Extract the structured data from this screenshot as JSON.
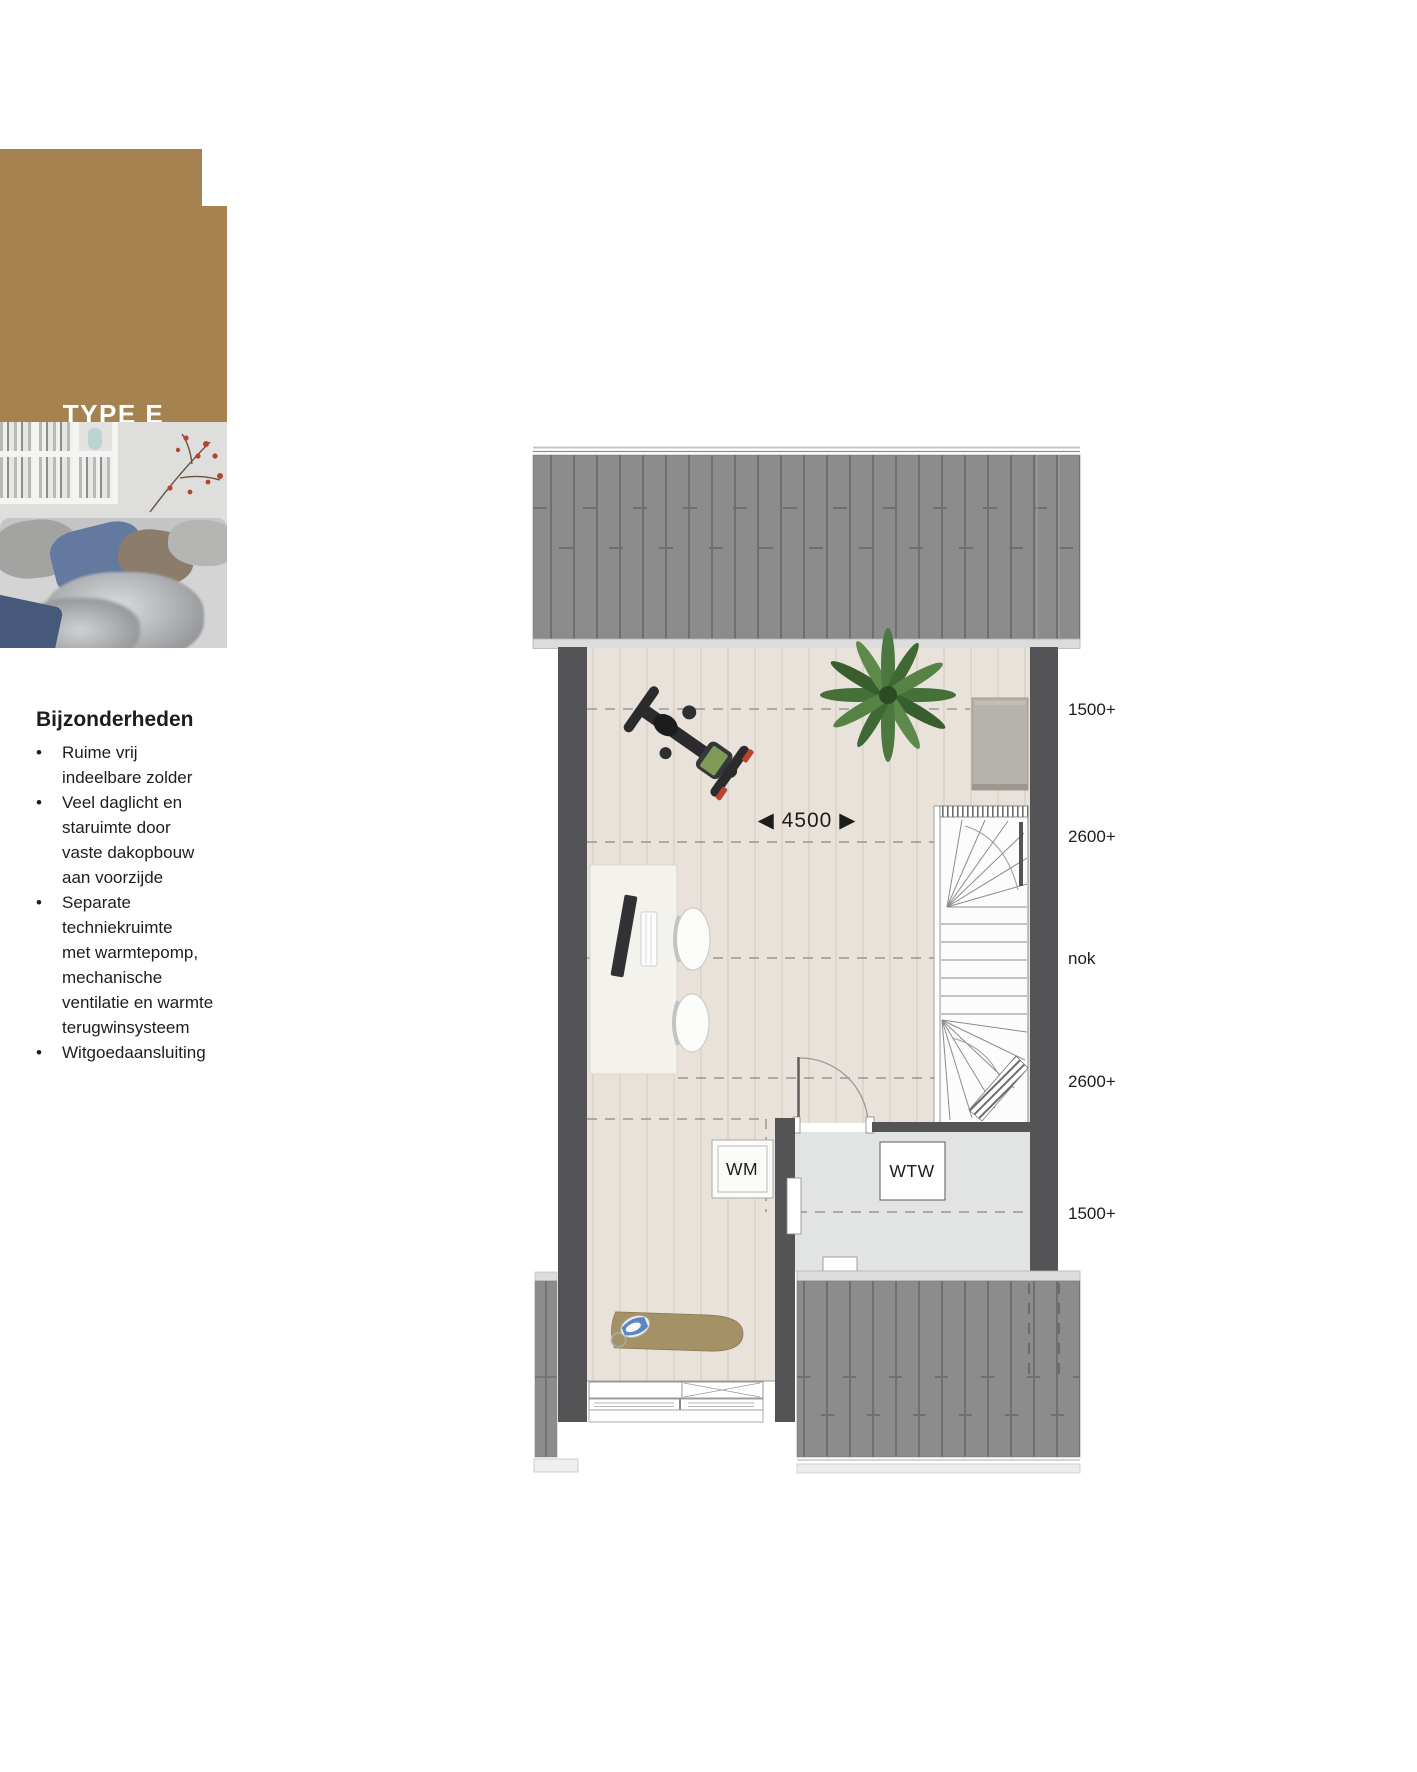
{
  "panel": {
    "type_label": "TYPE E",
    "floor_label": "zolder",
    "scale_label": "schaal 1:60",
    "accent_color": "#a5824f"
  },
  "features": {
    "heading": "Bijzonderheden",
    "bullet": "•",
    "items": [
      "Ruime vrij\nindeelbare zolder",
      "Veel daglicht en\nstaruimte door\nvaste dakopbouw\naan voorzijde",
      "Separate\ntechniekruimte\nmet warmtepomp,\nmechanische\nventilatie en warmte\nterugwinsysteem",
      "Witgoedaansluiting"
    ]
  },
  "plan": {
    "dimension_text": "◀ 4500 ▶",
    "height_labels": [
      "1500+",
      "2600+",
      "nok",
      "2600+",
      "1500+"
    ],
    "room_labels": {
      "wm": "WM",
      "wtw": "WTW"
    },
    "colors": {
      "roof": "#8c8c8c",
      "wall": "#545456",
      "wood_floor": "#e8e2da",
      "technique_floor": "#e2e4e3"
    }
  }
}
